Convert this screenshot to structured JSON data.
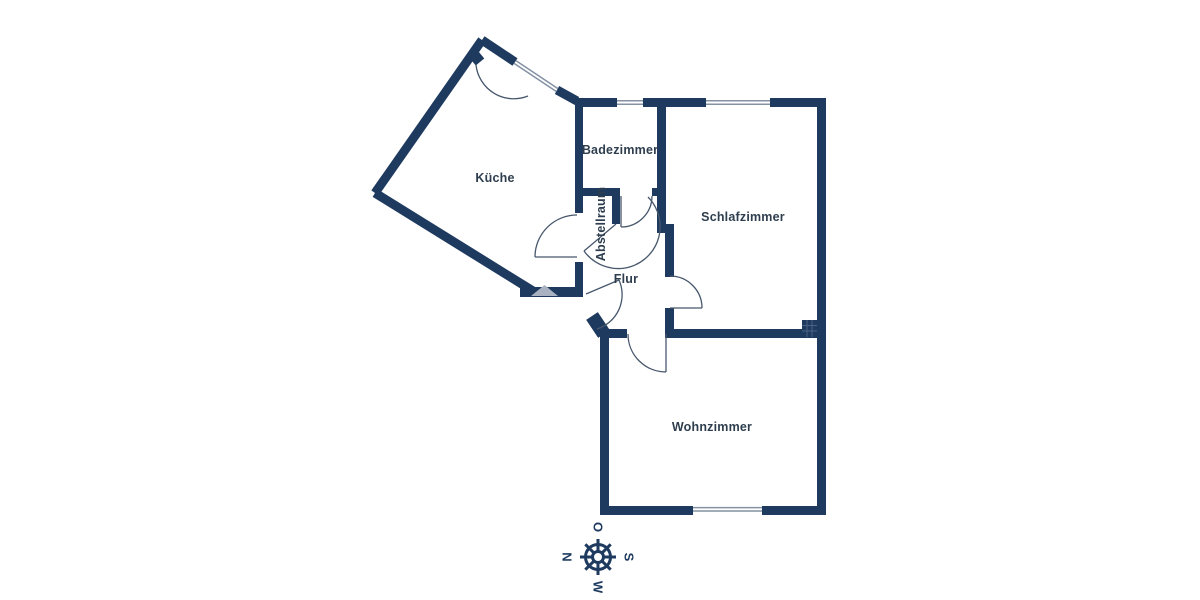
{
  "page": {
    "background": "#ffffff",
    "type": "apartment-floor-plan"
  },
  "plan": {
    "wall_color": "#1e3a5f",
    "label_color": "#2e3e4e",
    "door_arc_color": "#47576c",
    "window_glass_color": "#8492a4",
    "entry_marker_color": "#a8b2c1",
    "rooms": [
      {
        "id": "kueche",
        "label": "Küche",
        "label_x": 495,
        "label_y": 182,
        "rotation": 0
      },
      {
        "id": "badezimmer",
        "label": "Badezimmer",
        "label_x": 620,
        "label_y": 154,
        "rotation": 0
      },
      {
        "id": "abstellraum",
        "label": "Abstellraum",
        "label_x": 601,
        "label_y": 228,
        "rotation": -90
      },
      {
        "id": "flur",
        "label": "Flur",
        "label_x": 626,
        "label_y": 283,
        "rotation": 0
      },
      {
        "id": "schlafzimmer",
        "label": "Schlafzimmer",
        "label_x": 743,
        "label_y": 221,
        "rotation": 0
      },
      {
        "id": "wohnzimmer",
        "label": "Wohnzimmer",
        "label_x": 712,
        "label_y": 431,
        "rotation": 0
      }
    ],
    "windows": [
      {
        "room": "badezimmer",
        "side": "top"
      },
      {
        "room": "schlafzimmer",
        "side": "top"
      },
      {
        "room": "wohnzimmer",
        "side": "bottom"
      },
      {
        "room": "kueche",
        "side": "top-right-diagonal"
      }
    ],
    "compass": {
      "center_x": 598,
      "center_y": 557,
      "letters_rotated_deg": 90,
      "directions": [
        {
          "label": "O",
          "position": "top"
        },
        {
          "label": "S",
          "position": "right"
        },
        {
          "label": "W",
          "position": "bottom"
        },
        {
          "label": "N",
          "position": "left"
        }
      ]
    }
  }
}
